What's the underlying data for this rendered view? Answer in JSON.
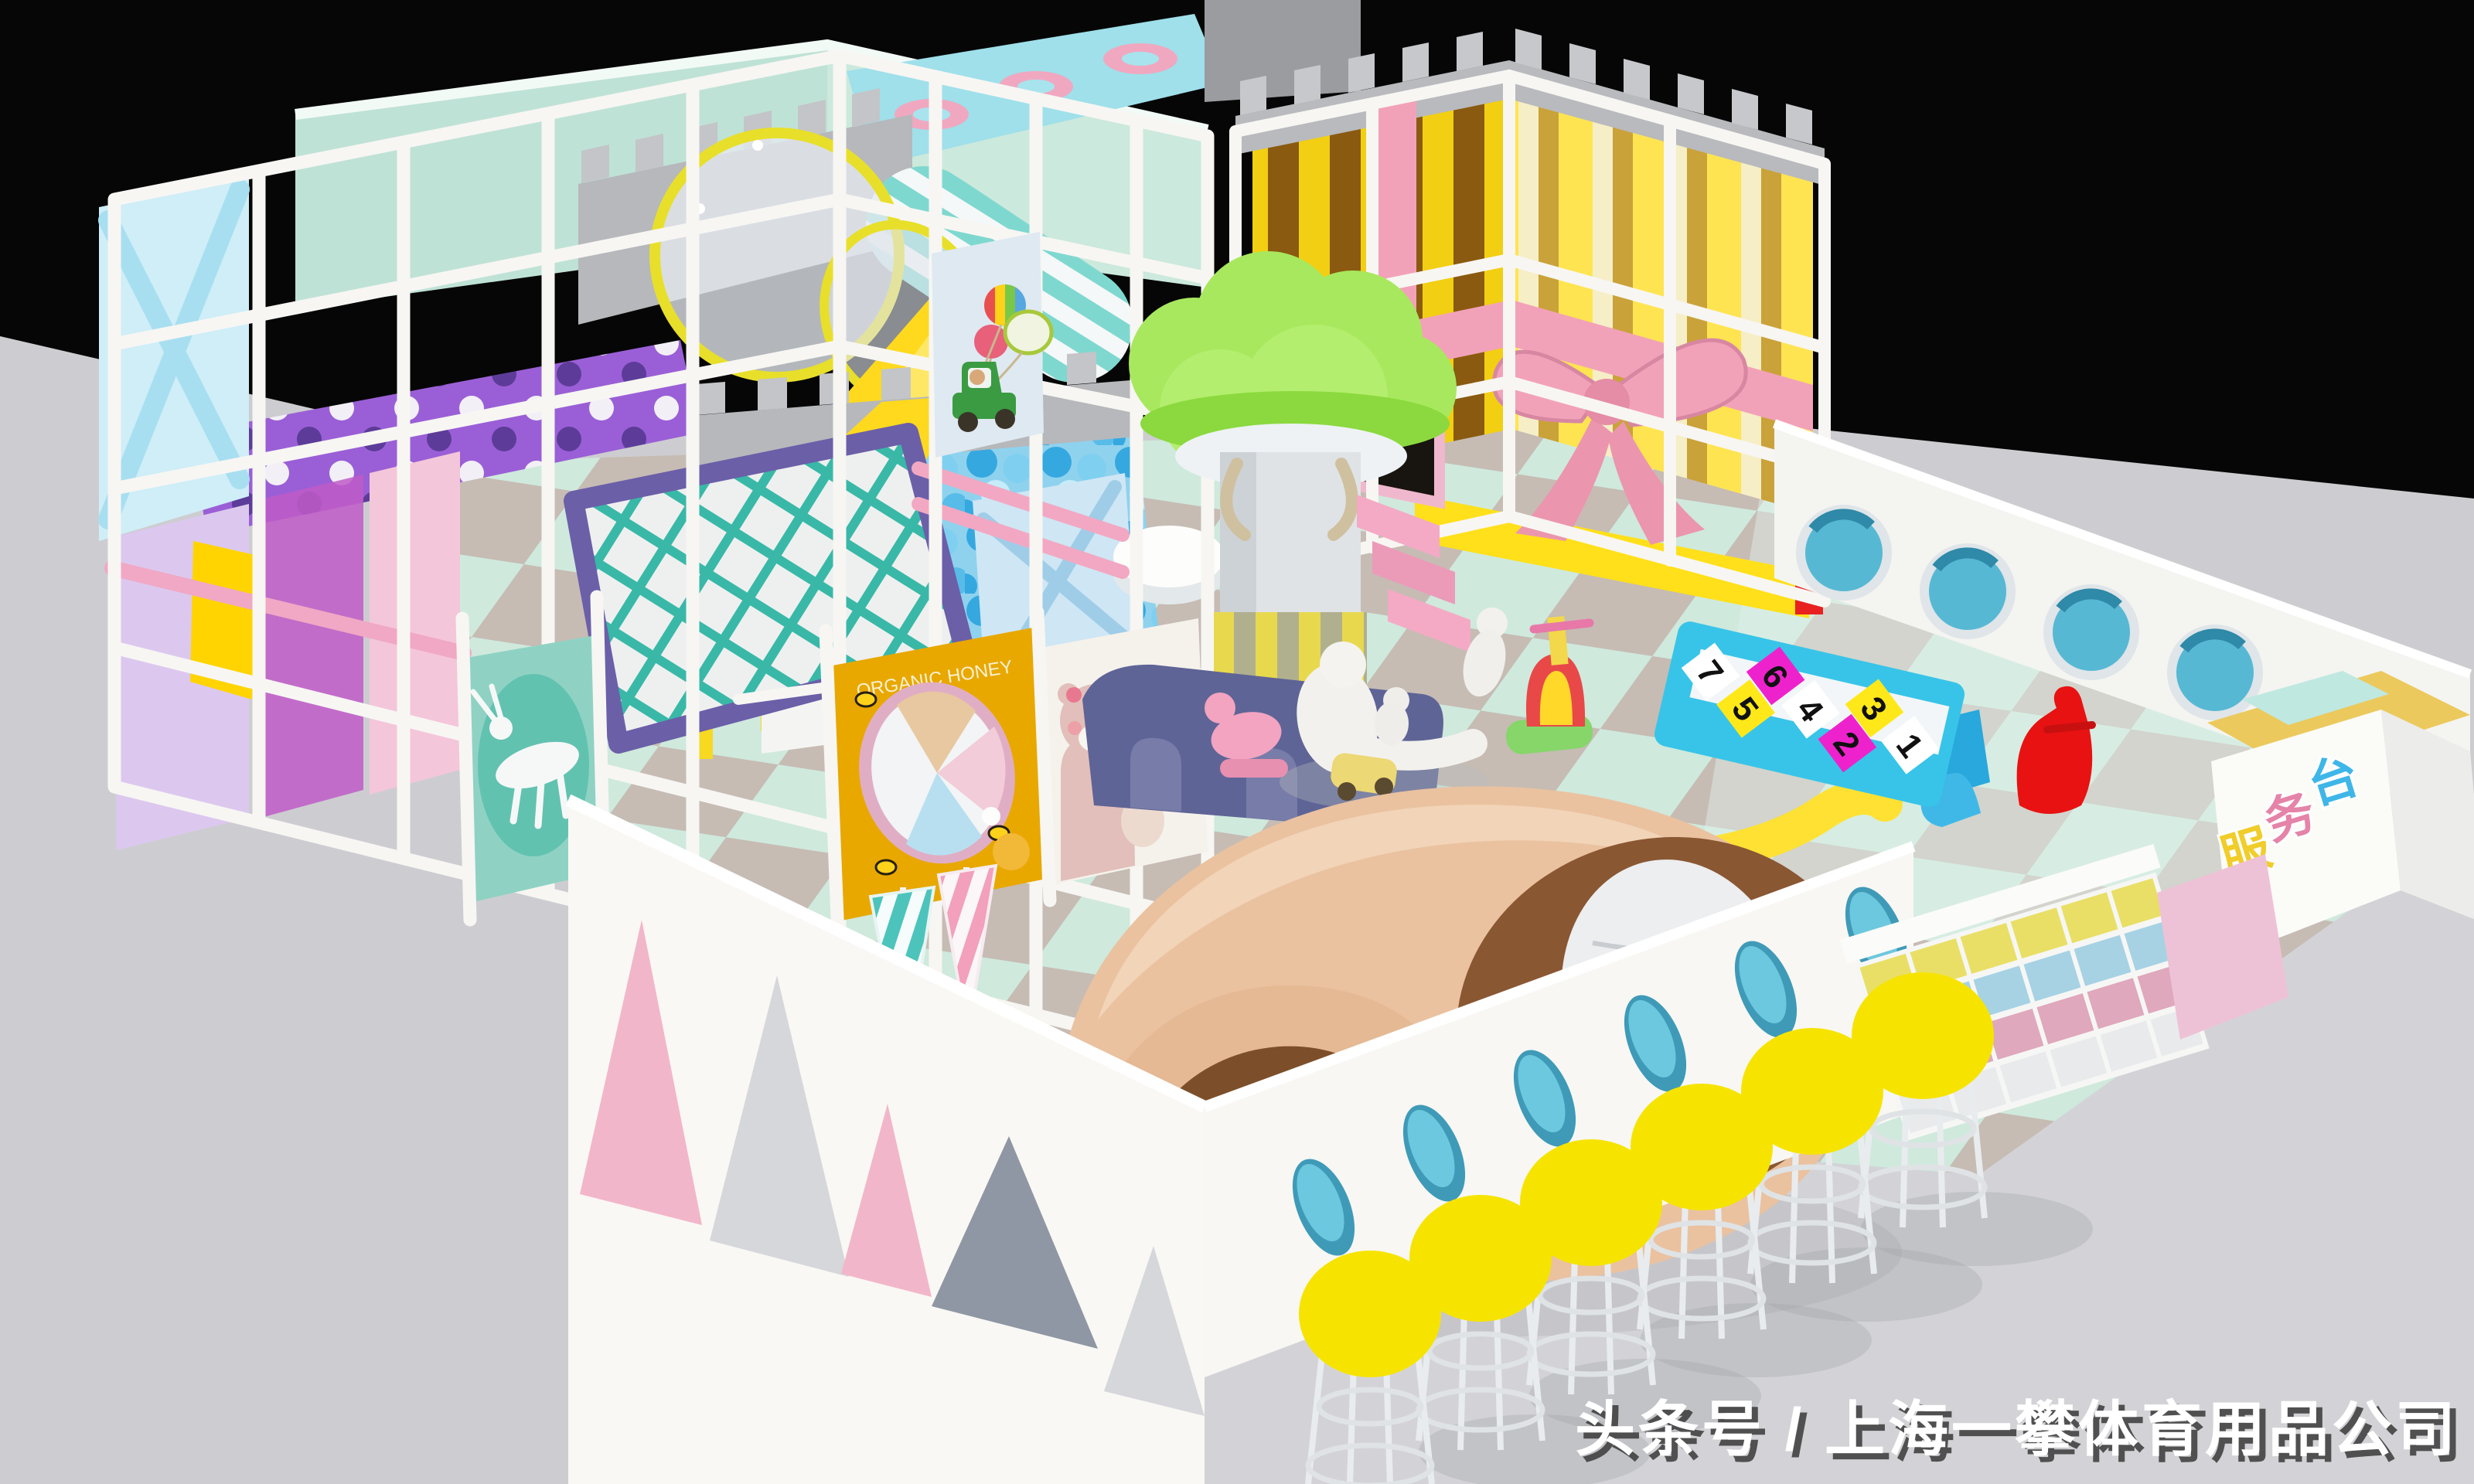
{
  "scene": {
    "backdrop": "#060606",
    "floor": "#cdcdd1",
    "description": "3D render of a pastel indoor children soft-play center on a black backdrop"
  },
  "watermark": {
    "text": "头条号 / 上海一攀体育用品公司",
    "color": "#ffffff"
  },
  "counter": {
    "sign_chars": [
      {
        "ch": "服",
        "color": "#f0cd2a"
      },
      {
        "ch": "务",
        "color": "#e583a8"
      },
      {
        "ch": "台",
        "color": "#3fb6e8"
      }
    ]
  },
  "hopscotch": {
    "base_color": "#38c4e8",
    "tiles": [
      {
        "n": "7",
        "bg": "#ffffff"
      },
      {
        "n": "5",
        "bg": "#ffe81a"
      },
      {
        "n": "6",
        "bg": "#ee22cc"
      },
      {
        "n": "4",
        "bg": "#ffffff"
      },
      {
        "n": "2",
        "bg": "#ee22cc"
      },
      {
        "n": "3",
        "bg": "#ffe81a"
      },
      {
        "n": "1",
        "bg": "#ffffff"
      }
    ]
  },
  "posters": {
    "bear_bubble_line1": "LOVE YOU",
    "bear_bubble_line2": "抱抱",
    "honey_text": "ORGANIC HONEY"
  },
  "palette": {
    "pipe_white": "#f7f6f3",
    "mint_wall": "#bfe2d6",
    "castle_gray": "#b6b8bb",
    "castle_yellow": "#f2cf12",
    "castle_brown": "#8a5a10",
    "ribbon_pink": "#f2a2b8",
    "ball_blue": "#35a8e0",
    "slide_yellow": "#ffd91e",
    "net_teal": "#39b8a8",
    "net_purple": "#6b5fa8",
    "tree_green": "#a8e85e",
    "roll_tan": "#eac2a0",
    "roll_brown": "#8a5733",
    "stool_yellow": "#f6e400",
    "mat_mint": "#cfe9dd",
    "mat_gray": "#c6bcb4",
    "triangle_pink": "#f2b6ca",
    "triangle_gray": "#8f97a4"
  }
}
